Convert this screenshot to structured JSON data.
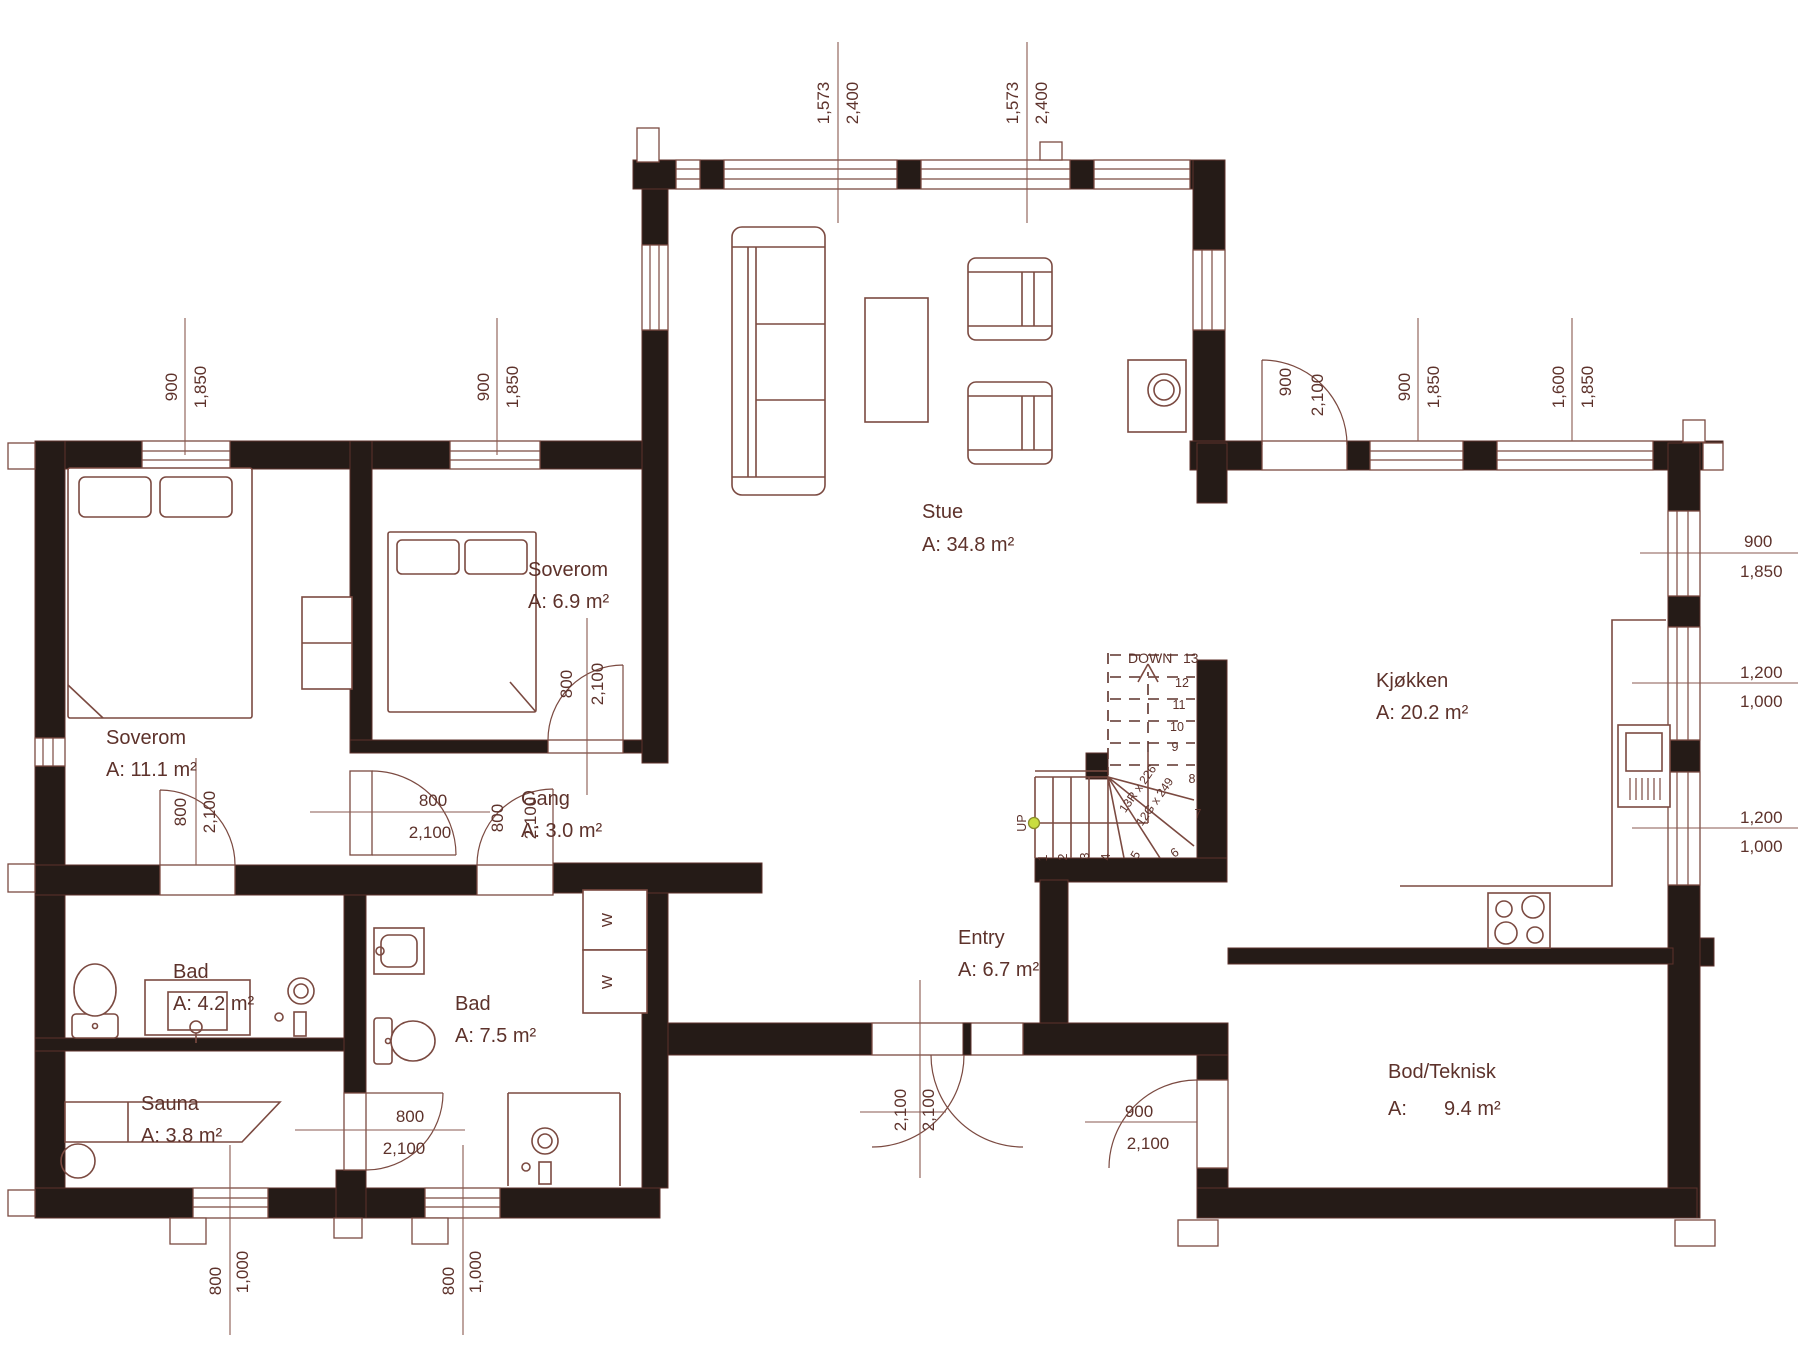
{
  "colors": {
    "wall": "#251b17",
    "line": "#7b4a41",
    "text": "#5d322b",
    "accent_dot": "#c9dd3f",
    "bg": "#ffffff"
  },
  "rooms": {
    "stue": {
      "name": "Stue",
      "area": "A: 34.8 m²"
    },
    "kjokken": {
      "name": "Kjøkken",
      "area": "A: 20.2 m²"
    },
    "soverom1": {
      "name": "Soverom",
      "area": "A: 11.1 m²"
    },
    "soverom2": {
      "name": "Soverom",
      "area": "A: 6.9 m²"
    },
    "gang": {
      "name": "Gang",
      "area": "A: 3.0 m²"
    },
    "bad1": {
      "name": "Bad",
      "area": "A: 4.2 m²"
    },
    "bad2": {
      "name": "Bad",
      "area": "A: 7.5 m²"
    },
    "sauna": {
      "name": "Sauna",
      "area": "A: 3.8 m²"
    },
    "entry": {
      "name": "Entry",
      "area": "A: 6.7 m²"
    },
    "bod": {
      "name": "Bod/Teknisk",
      "area_prefix": "A:",
      "area_value": "9.4 m²"
    }
  },
  "dims": {
    "top1": {
      "a": "1,573",
      "b": "2,400"
    },
    "top2": {
      "a": "1,573",
      "b": "2,400"
    },
    "lw_top1": {
      "a": "900",
      "b": "1,850"
    },
    "lw_top2": {
      "a": "900",
      "b": "1,850"
    },
    "kt_door": {
      "a": "900",
      "b": "2,100"
    },
    "kt_win1": {
      "a": "900",
      "b": "1,850"
    },
    "kt_win2": {
      "a": "1,600",
      "b": "1,850"
    },
    "right1": {
      "a": "900",
      "b": "1,850"
    },
    "right2": {
      "a": "1,200",
      "b": "1,000"
    },
    "right3": {
      "a": "1,200",
      "b": "1,000"
    },
    "sov1_door": {
      "a": "800",
      "b": "2,100"
    },
    "sov1_gang": {
      "a": "800",
      "b": "2,100"
    },
    "sov2_door": {
      "a": "800",
      "b": "2,100"
    },
    "gang_bad2": {
      "a": "800",
      "b": "2,100"
    },
    "sauna_door": {
      "a": "800",
      "b": "2,100"
    },
    "entry_door": {
      "a": "2,100",
      "b": "2,100"
    },
    "bod_door": {
      "a": "900",
      "b": "2,100"
    },
    "bottom_win1": {
      "a": "800",
      "b": "1,000"
    },
    "bottom_win2": {
      "a": "800",
      "b": "1,000"
    }
  },
  "stairs": {
    "down": "DOWN",
    "top_step": "13",
    "steps_upper": [
      "12",
      "11",
      "10",
      "9",
      "8",
      "7",
      "6"
    ],
    "steps_lower": [
      "1",
      "2",
      "3",
      "4",
      "5"
    ],
    "up": "UP",
    "risers": "13R x 226",
    "goings": "12G x 249"
  },
  "closets": {
    "w1": "W",
    "w2": "W"
  }
}
